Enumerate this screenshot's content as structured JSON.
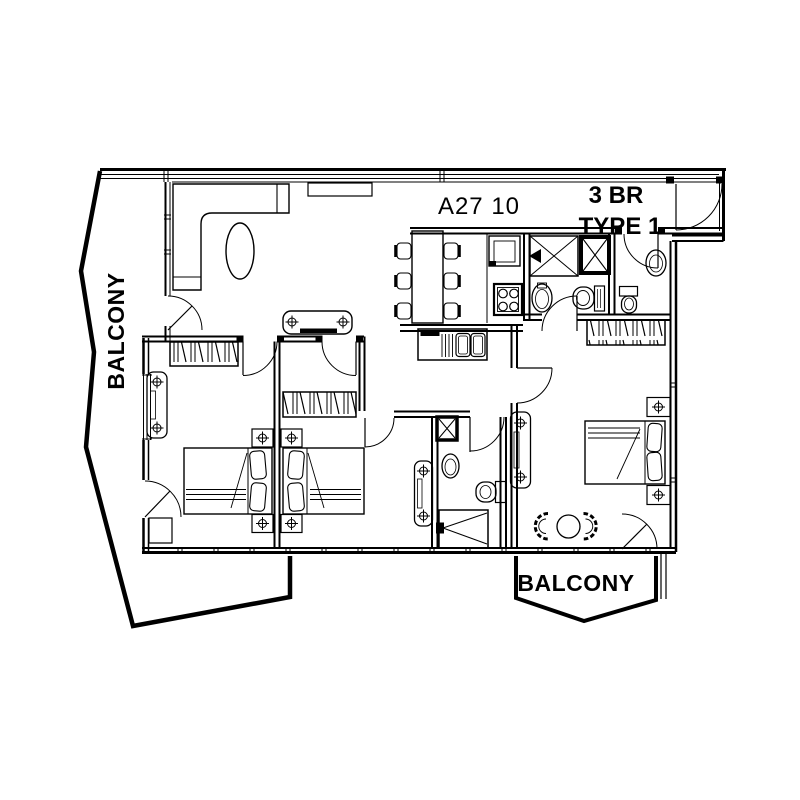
{
  "drawing": {
    "unit_number": "A27 10",
    "unit_type_line1": "3 BR",
    "unit_type_line2": "TYPE 1",
    "balcony_left_label": "BALCONY",
    "balcony_bottom_label": "BALCONY"
  },
  "colors": {
    "line": "#000000",
    "background": "#ffffff",
    "text": "#000000"
  }
}
